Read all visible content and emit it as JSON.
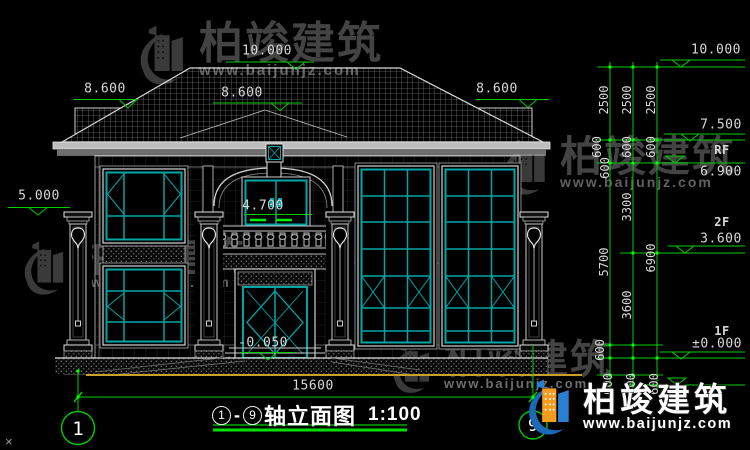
{
  "brand": {
    "name": "柏竣建筑",
    "url": "www.baijunjz.com"
  },
  "title": {
    "axis_start": "1",
    "separator": "-",
    "axis_end": "9",
    "name": "轴立面图",
    "scale": "1:100"
  },
  "axis_bubbles": {
    "left": "1",
    "right": "9"
  },
  "elevation_labels": {
    "eave_left": "8.600",
    "ridge": "10.000",
    "bay_ridge": "8.600",
    "eave_right": "8.600",
    "pillar_top": "5.000",
    "balcony_sill": "4.700",
    "entrance": "-0.050"
  },
  "floor_levels": {
    "ridge": "10.000",
    "parapet": "7.500",
    "rf": "RF",
    "roof": "6.900",
    "f2": "2F",
    "f2_level": "3.600",
    "f1": "1F",
    "f1_level": "±0.000"
  },
  "dims": {
    "total_width": "15600",
    "col_a": [
      "2500",
      "600",
      "600",
      "5700",
      "600",
      "600"
    ],
    "col_b": [
      "2500",
      "600",
      "3300",
      "3600",
      "600"
    ],
    "col_c": [
      "2500",
      "600",
      "6900",
      "600"
    ]
  },
  "corner_mark": "×"
}
